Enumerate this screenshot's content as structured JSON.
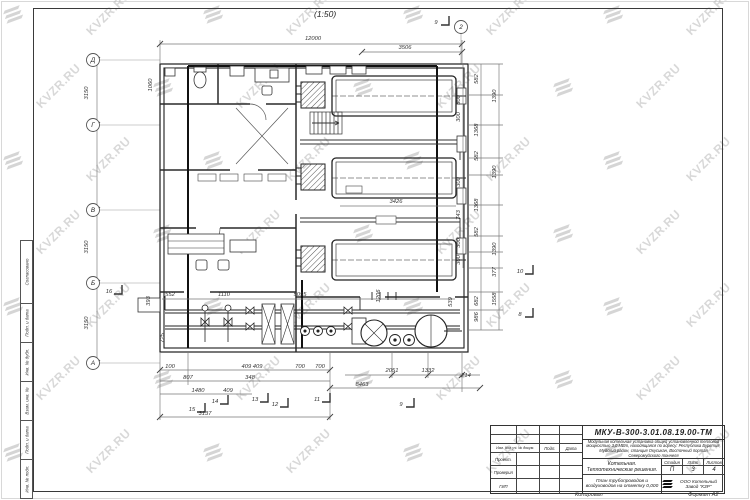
{
  "page": {
    "scale_label": "(1:50)",
    "footer_left": "Копировал",
    "footer_right": "Формат А2"
  },
  "watermark": {
    "text": "KVZR.RU"
  },
  "side_strip": {
    "cells": [
      "Согласовано",
      "Подп. и дата",
      "Инв. № дубл.",
      "Взам. инв. №",
      "Подп. и дата",
      "Инв. № подл."
    ]
  },
  "title_block": {
    "doc_number": "МКУ-В-300-3.01.08.19.00-ТМ",
    "description": "Модульная котельная установка общей установленной тепловой мощностью 3,0 МВт, находящаяся по адресу: Республика Бурятия, Муйский район, станция Окусикан, Восточный портал Северомуйского тоннеля",
    "object_title": "Котельная. Теплотехнические решения.",
    "stage_label": "Стадия",
    "sheet_label": "Лист",
    "sheets_label": "Листов",
    "stage": "П",
    "sheet": "3",
    "sheets": "4",
    "sheet_title": "План трубопроводов и воздуховодов на отметку 0,000",
    "company": "ООО Котельный Завод \"КЗР\"",
    "header_cols": [
      "Изм. Кол.уч. № докум.",
      "Подп.",
      "Дата"
    ],
    "rows": [
      "Проект.",
      "Проверил",
      "ГИП"
    ]
  },
  "plan": {
    "grid_bubbles": [
      [
        "Д",
        93,
        60
      ],
      [
        "Г",
        93,
        125
      ],
      [
        "В",
        93,
        210
      ],
      [
        "Б",
        93,
        283
      ],
      [
        "А",
        93,
        363
      ],
      [
        "2",
        461,
        27
      ]
    ],
    "section_markers": [
      [
        "9",
        437,
        22
      ],
      [
        "15",
        193,
        409
      ],
      [
        "14",
        216,
        401
      ],
      [
        "13",
        256,
        399
      ],
      [
        "12",
        276,
        404
      ],
      [
        "11",
        318,
        399
      ],
      [
        "9",
        402,
        404
      ],
      [
        "10",
        521,
        271
      ],
      [
        "8",
        521,
        314
      ],
      [
        "16",
        110,
        291
      ]
    ],
    "dims": [
      [
        "12000",
        313,
        40,
        0
      ],
      [
        "3506",
        405,
        49,
        0
      ],
      [
        "3426",
        396,
        203,
        0
      ],
      [
        "3150",
        88,
        93,
        -90
      ],
      [
        "3150",
        88,
        247,
        -90
      ],
      [
        "3150",
        88,
        323,
        -90
      ],
      [
        "1060",
        152,
        85,
        -90
      ],
      [
        "393",
        150,
        301,
        -90
      ],
      [
        "725",
        164,
        338,
        -90
      ],
      [
        "552",
        170,
        296,
        0
      ],
      [
        "1110",
        224,
        296,
        0
      ],
      [
        "5055",
        300,
        296,
        0
      ],
      [
        "300",
        460,
        100,
        -90
      ],
      [
        "300",
        460,
        117,
        -90
      ],
      [
        "300",
        460,
        182,
        -90
      ],
      [
        "743",
        460,
        215,
        -90
      ],
      [
        "300",
        460,
        243,
        -90
      ],
      [
        "300",
        460,
        260,
        -90
      ],
      [
        "582",
        478,
        79,
        -90
      ],
      [
        "1368",
        478,
        130,
        -90
      ],
      [
        "582",
        478,
        156,
        -90
      ],
      [
        "1368",
        478,
        205,
        -90
      ],
      [
        "582",
        478,
        232,
        -90
      ],
      [
        "682",
        478,
        301,
        -90
      ],
      [
        "986",
        478,
        317,
        -90
      ],
      [
        "1390",
        496,
        96,
        -90
      ],
      [
        "1390",
        496,
        172,
        -90
      ],
      [
        "1390",
        496,
        249,
        -90
      ],
      [
        "377",
        496,
        272,
        -90
      ],
      [
        "1558",
        496,
        299,
        -90
      ],
      [
        "1206",
        380,
        296,
        -90
      ],
      [
        "539",
        452,
        302,
        -90
      ],
      [
        "100",
        170,
        368,
        0
      ],
      [
        "409 409",
        252,
        368,
        0
      ],
      [
        "700",
        300,
        368,
        0
      ],
      [
        "700",
        320,
        368,
        0
      ],
      [
        "807",
        188,
        379,
        0
      ],
      [
        "348",
        250,
        379,
        0
      ],
      [
        "1480",
        198,
        392,
        0
      ],
      [
        "409",
        228,
        392,
        0
      ],
      [
        "3137",
        205,
        415,
        0
      ],
      [
        "2051",
        392,
        372,
        0
      ],
      [
        "1332",
        428,
        372,
        0
      ],
      [
        "214",
        466,
        377,
        0
      ],
      [
        "8463",
        362,
        386,
        0
      ]
    ]
  }
}
